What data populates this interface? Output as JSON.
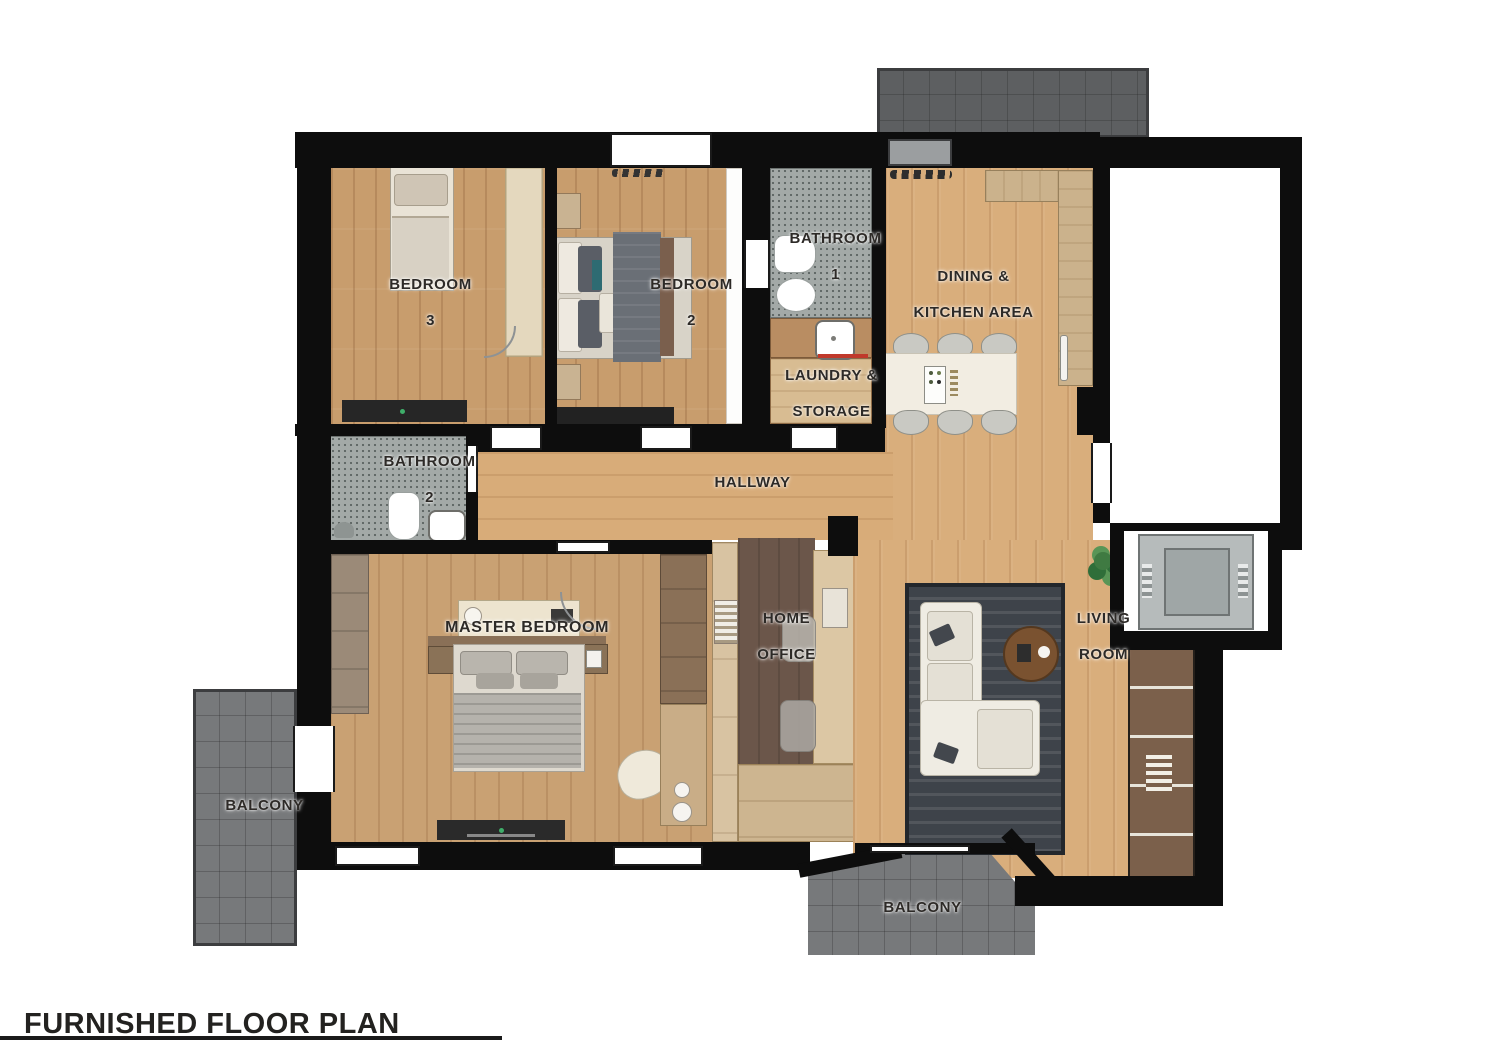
{
  "title": {
    "text": "FURNISHED FLOOR PLAN"
  },
  "rooms": {
    "bedroom3": {
      "line1": "BEDROOM",
      "line2": "3"
    },
    "bedroom2": {
      "line1": "BEDROOM",
      "line2": "2"
    },
    "bathroom1": {
      "line1": "BATHROOM",
      "line2": "1"
    },
    "dining_kitchen": {
      "line1": "DINING &",
      "line2": "KITCHEN AREA"
    },
    "laundry": {
      "line1": "LAUNDRY &",
      "line2": "STORAGE"
    },
    "bathroom2": {
      "line1": "BATHROOM",
      "line2": "2"
    },
    "hallway": {
      "label": "HALLWAY"
    },
    "master": {
      "label": "MASTER BEDROOM"
    },
    "office": {
      "line1": "HOME",
      "line2": "OFFICE"
    },
    "living": {
      "line1": "LIVING",
      "line2": "ROOM"
    },
    "balcony_left": {
      "label": "BALCONY"
    },
    "balcony_bottom": {
      "label": "BALCONY"
    }
  },
  "colors": {
    "wall": "#0d0d0d",
    "wood_light": "#d9ae7c",
    "wood_bedroom": "#c89d6d",
    "wood_master": "#c9a173",
    "bathroom_floor": "#a3a9a7",
    "balcony_tile": "#77797b",
    "terrace_tile": "#5d5f61",
    "office_floor": "#6b564a",
    "divider_wood": "#d8c3a2",
    "walnut": "#8a7057",
    "counter": "#cbb28c",
    "island": "#f2ede2",
    "rug": "#3e434a",
    "stairs_wood": "#7b604b",
    "accent_red": "#c0392b",
    "plant_green": "#3f7a42",
    "elevator_gray": "#b6bbbb"
  }
}
